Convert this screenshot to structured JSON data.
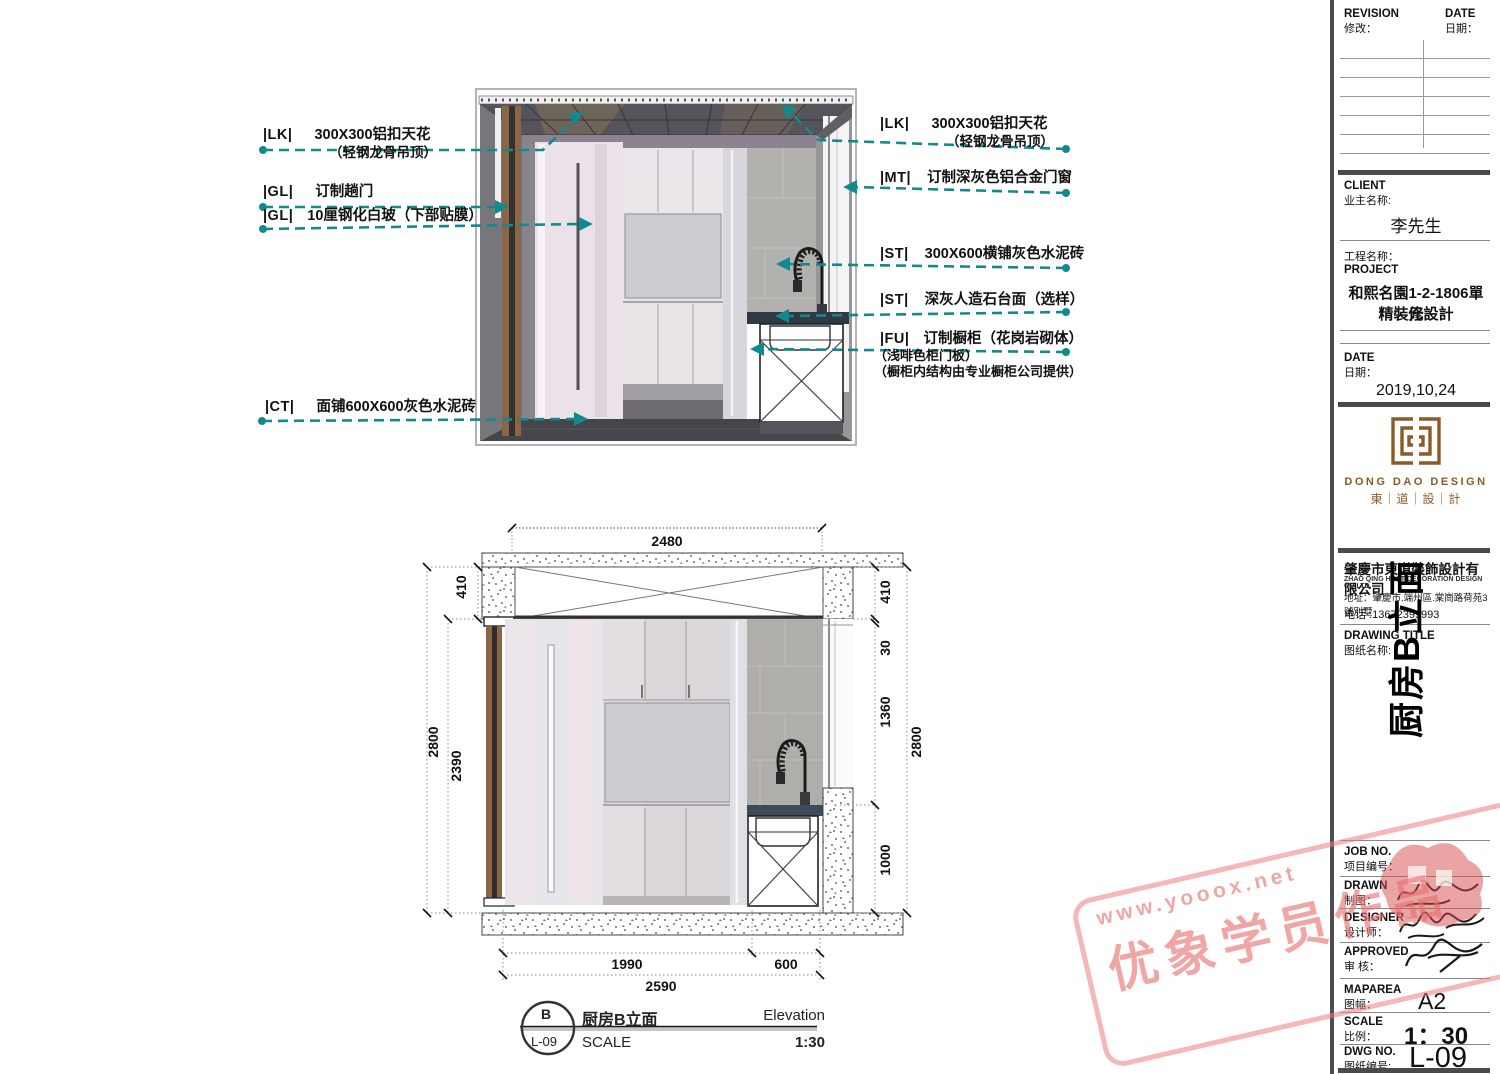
{
  "annotations": {
    "left": [
      {
        "tag": "|LK|",
        "text": "300X300铝扣天花",
        "sub": "（轻钢龙骨吊顶）"
      },
      {
        "tag": "|GL|",
        "text": "订制趟门"
      },
      {
        "tag": "|GL|",
        "text": "10厘钢化白玻（下部贴膜）"
      },
      {
        "tag": "|CT|",
        "text": "面铺600X600灰色水泥砖"
      }
    ],
    "right": [
      {
        "tag": "|LK|",
        "text": "300X300铝扣天花",
        "sub": "（轻钢龙骨吊顶）"
      },
      {
        "tag": "|MT|",
        "text": "订制深灰色铝合金门窗"
      },
      {
        "tag": "|ST|",
        "text": "300X600横铺灰色水泥砖"
      },
      {
        "tag": "|ST|",
        "text": "深灰人造石台面（选样）"
      },
      {
        "tag": "|FU|",
        "text": "订制橱柜（花岗岩砌体）",
        "sub1": "（浅啡色柜门板）",
        "sub2": "（橱柜内结构由专业橱柜公司提供）"
      }
    ]
  },
  "dimensions": {
    "top": "2480",
    "left_top": "410",
    "left": [
      "2800",
      "2390"
    ],
    "right": [
      "410",
      "30",
      "1360",
      "1000"
    ],
    "right_total": "2800",
    "bottom": [
      "1990",
      "600"
    ],
    "bottom_total": "2590"
  },
  "scale_bar": {
    "bubble_top": "B",
    "bubble_bottom": "L-09",
    "title": "厨房B立面",
    "label_right": "Elevation",
    "label_scale": "SCALE",
    "value_scale": "1:30"
  },
  "title_block": {
    "revision": {
      "en": "REVISION",
      "cn": "修改：",
      "date_en": "DATE",
      "date_cn": "日期："
    },
    "client": {
      "label_en": "CLIENT",
      "label_cn": "业主名称:",
      "name": "李先生"
    },
    "project": {
      "label_cn": "工程名称：",
      "label_en": "PROJECT",
      "name_line1": "和熙名園1-2-1806單元",
      "name_line2": "精裝修設計"
    },
    "date": {
      "label_en": "DATE",
      "label_cn": "日期：",
      "value": "2019,10,24"
    },
    "logo": {
      "en": "DONG DAO DESIGN",
      "cn": "東｜道｜設｜計"
    },
    "company": {
      "name": "肇慶市東道裝飾設計有限公司",
      "name_en": "ZHAO QING HOST DECORATION DESIGN CO.LTD.",
      "address": "地址：肇慶市.端州區.棠崗路荷苑3號別墅",
      "phone": "电话 :13672399993"
    },
    "drawing_title": {
      "label_en": "DRAWING TITLE",
      "label_cn": "图纸名称:",
      "value": "厨房B立面"
    },
    "job_no": {
      "label_en": "JOB NO.",
      "label_cn": "项目编号："
    },
    "drawn": {
      "label_en": "DRAWN",
      "label_cn": "制图："
    },
    "designer": {
      "label_en": "DESIGNER",
      "label_cn": "设计师："
    },
    "approved": {
      "label_en": "APPROVED",
      "label_cn": "审 核："
    },
    "maparea": {
      "label_en": "MAPAREA",
      "label_cn": "图幅：",
      "value": "A2"
    },
    "scale": {
      "label_en": "SCALE",
      "label_cn": "比例：",
      "value": "1：30"
    },
    "dwg_no": {
      "label_en": "DWG NO.",
      "label_cn": "图纸编号:",
      "value": "L-09"
    }
  },
  "watermark": {
    "url": "www.yooox.net",
    "text": "优象学员作品"
  },
  "colors": {
    "leader_teal": "#12898e",
    "stamp_pink": "#ec7e7e",
    "logo_brown": "#8c5a28"
  }
}
